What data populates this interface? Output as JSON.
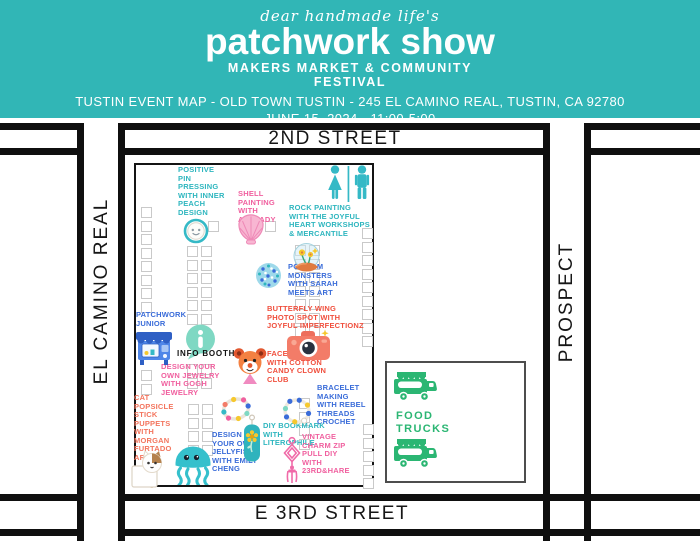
{
  "header": {
    "brand_script": "dear handmade life's",
    "logo": "patchwork show",
    "subtitle1": "MAKERS MARKET & COMMUNITY",
    "subtitle2": "FESTIVAL",
    "info_line": "TUSTIN EVENT MAP - OLD TOWN TUSTIN - 245 EL CAMINO REAL, TUSTIN, CA 92780",
    "date_line": "JUNE 15, 2024 - 11:00-5:00"
  },
  "streets": {
    "top": "2ND STREET",
    "bottom": "E 3RD STREET",
    "left": "EL CAMINO REAL",
    "right": "PROSPECT"
  },
  "colors": {
    "header_teal": "#31b6b6",
    "teal": "#2eb6bf",
    "pink": "#f0609f",
    "blue": "#3a6cd9",
    "coral": "#f04f3d",
    "salmon": "#f3755e",
    "green": "#2bb673",
    "black": "#111111"
  },
  "map": {
    "vendors": [
      {
        "id": "positive-pin",
        "label": "POSITIVE\nPIN\nPRESSING\nWITH INNER\nPEACH\nDESIGN",
        "color": "teal",
        "icon": "button-pin-icon"
      },
      {
        "id": "shell-painting",
        "label": "SHELL\nPAINTING\nWITH\nADELADY",
        "color": "pink",
        "icon": "seashell-icon"
      },
      {
        "id": "rock-painting",
        "label": "ROCK PAINTING\nWITH THE JOYFUL\nHEART WORKSHOPS\n& MERCANTILE",
        "color": "teal",
        "icon": "painted-rock-icon"
      },
      {
        "id": "pompom-monsters",
        "label": "POMPOM\nMONSTERS\nWITH SARAH\nMEETS ART",
        "color": "blue",
        "icon": "pompom-icon"
      },
      {
        "id": "butterfly-wing",
        "label": "BUTTERFLY WING\nPHOTO SPOT WITH\nJOYFUL IMPERFECTIONZ",
        "color": "coral",
        "icon": "camera-icon"
      },
      {
        "id": "patchwork-junior",
        "label": "PATCHWORK\nJUNIOR",
        "color": "blue",
        "icon": "kids-booth-icon"
      },
      {
        "id": "face-painting",
        "label": "FACE PAINTING\nWITH COTTON\nCANDY CLOWN\nCLUB",
        "color": "coral",
        "icon": "clown-face-icon"
      },
      {
        "id": "gogh-jewelry",
        "label": "DESIGN YOUR\nOWN JEWELRY\nWITH GOGH\nJEWELRY",
        "color": "pink",
        "icon": "bead-bracelet-icon"
      },
      {
        "id": "cat-popsicle",
        "label": "CAT\nPOPSICLE\nSTICK\nPUPPETS\nWITH\nMORGAN\nFURTADO\nART",
        "color": "salmon",
        "icon": "cat-puppet-icon"
      },
      {
        "id": "bracelet-making",
        "label": "BRACELET\nMAKING\nWITH REBEL\nTHREADS\nCROCHET",
        "color": "blue",
        "icon": "crochet-bracelet-icon"
      },
      {
        "id": "diy-bookmark",
        "label": "DIY BOOKMARK\nWITH\nLITEROPHILE",
        "color": "teal",
        "icon": "bookmark-icon"
      },
      {
        "id": "jellyfish",
        "label": "DESIGN\nYOUR OWN\nJELLYFISH!\nWITH EMILY\nCHENG",
        "color": "blue",
        "icon": "jellyfish-icon"
      },
      {
        "id": "vintage-charm",
        "label": "VINTAGE\nCHARM ZIP\nPULL DIY\nWITH\n23RD&HARE",
        "color": "pink",
        "icon": "charm-tassel-icon"
      }
    ],
    "info_booth_label": "INFO BOOTH",
    "food_trucks_label": "FOOD\nTRUCKS",
    "restrooms": {
      "icons": [
        "woman-icon",
        "man-icon"
      ]
    },
    "booth_slot_strips": [
      {
        "x": 141,
        "y": 207,
        "cols": 1,
        "rows": 8
      },
      {
        "x": 141,
        "y": 370,
        "cols": 1,
        "rows": 2
      },
      {
        "x": 187,
        "y": 246,
        "cols": 2,
        "rows": 6
      },
      {
        "x": 187,
        "y": 364,
        "cols": 2,
        "rows": 2
      },
      {
        "x": 188,
        "y": 404,
        "cols": 2,
        "rows": 4
      },
      {
        "x": 295,
        "y": 245,
        "cols": 2,
        "rows": 7
      },
      {
        "x": 299,
        "y": 398,
        "cols": 1,
        "rows": 4
      },
      {
        "x": 362,
        "y": 228,
        "cols": 1,
        "rows": 9
      },
      {
        "x": 363,
        "y": 424,
        "cols": 1,
        "rows": 5
      },
      {
        "x": 208,
        "y": 221,
        "cols": 1,
        "rows": 1
      },
      {
        "x": 265,
        "y": 221,
        "cols": 1,
        "rows": 1
      }
    ]
  }
}
